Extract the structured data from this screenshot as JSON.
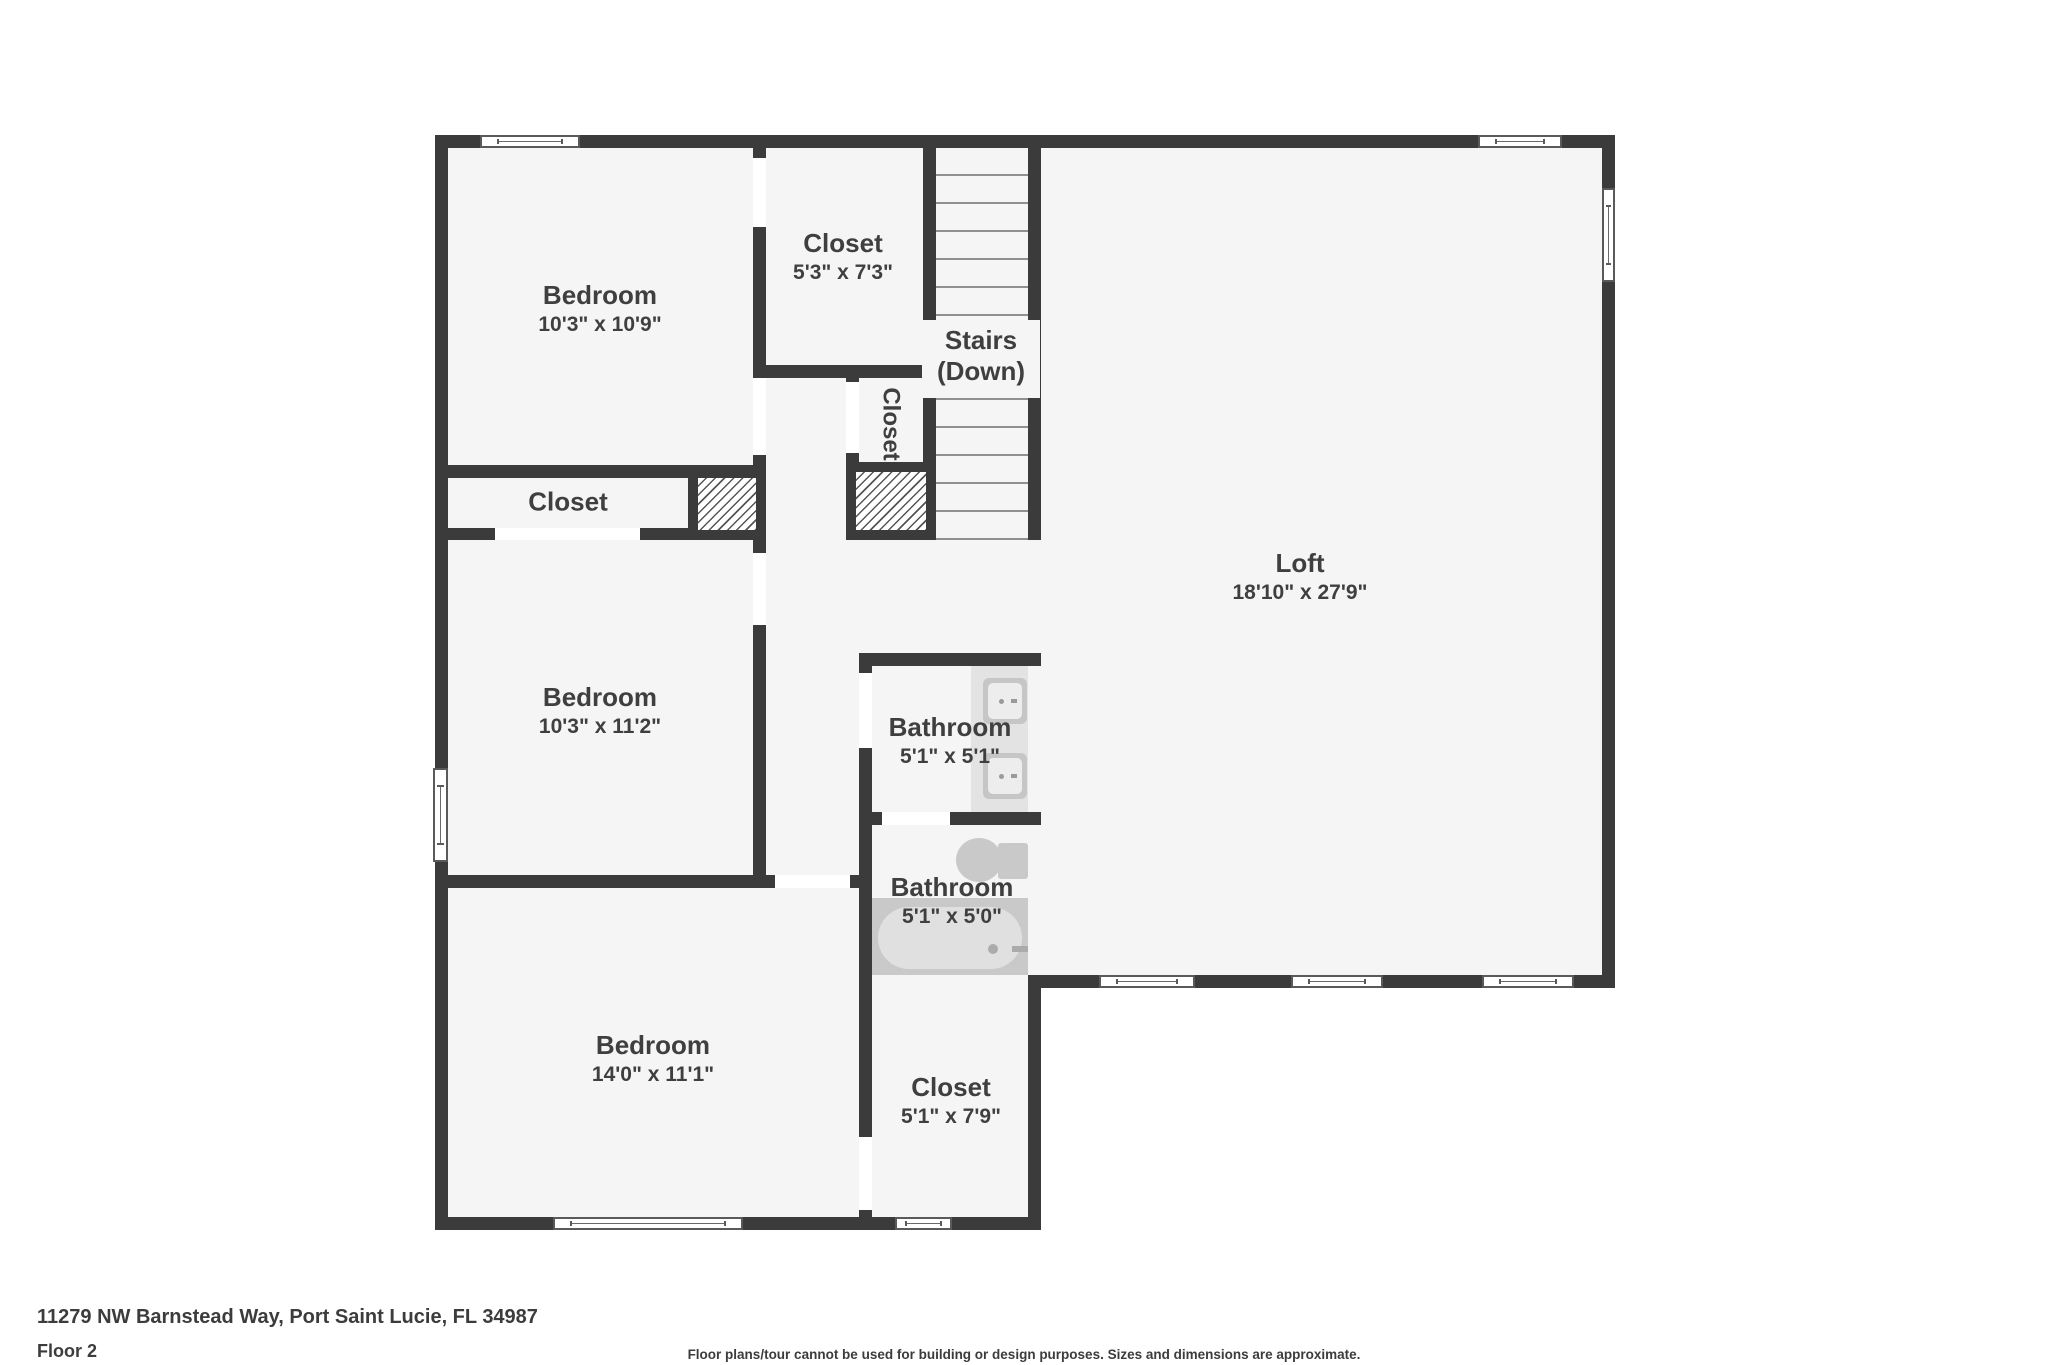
{
  "colors": {
    "wall": "#3b3b3b",
    "room_fill": "#f5f5f5",
    "fixture_gray": "#c9c9c9",
    "fixture_light": "#e0e0e0",
    "text": "#3f3f3f"
  },
  "floor_plan": {
    "rooms": {
      "bedroom_top_left": {
        "name": "Bedroom",
        "dims": "10'3\" x 10'9\""
      },
      "closet_top": {
        "name": "Closet",
        "dims": "5'3\" x 7'3\""
      },
      "stairs": {
        "line1": "Stairs",
        "line2": "(Down)"
      },
      "closet_vertical": {
        "name": "Closet"
      },
      "closet_mid_left": {
        "name": "Closet"
      },
      "loft": {
        "name": "Loft",
        "dims": "18'10\" x 27'9\""
      },
      "bedroom_mid_left": {
        "name": "Bedroom",
        "dims": "10'3\" x 11'2\""
      },
      "bathroom_upper": {
        "name": "Bathroom",
        "dims": "5'1\" x 5'1\""
      },
      "bathroom_lower": {
        "name": "Bathroom",
        "dims": "5'1\" x 5'0\""
      },
      "bedroom_bottom": {
        "name": "Bedroom",
        "dims": "14'0\" x 11'1\""
      },
      "closet_bottom": {
        "name": "Closet",
        "dims": "5'1\" x 7'9\""
      }
    }
  },
  "footer": {
    "address": "11279 NW Barnstead Way, Port Saint Lucie, FL 34987",
    "floor_label": "Floor 2",
    "disclaimer": "Floor plans/tour cannot be used for building or design purposes. Sizes and dimensions are approximate."
  }
}
